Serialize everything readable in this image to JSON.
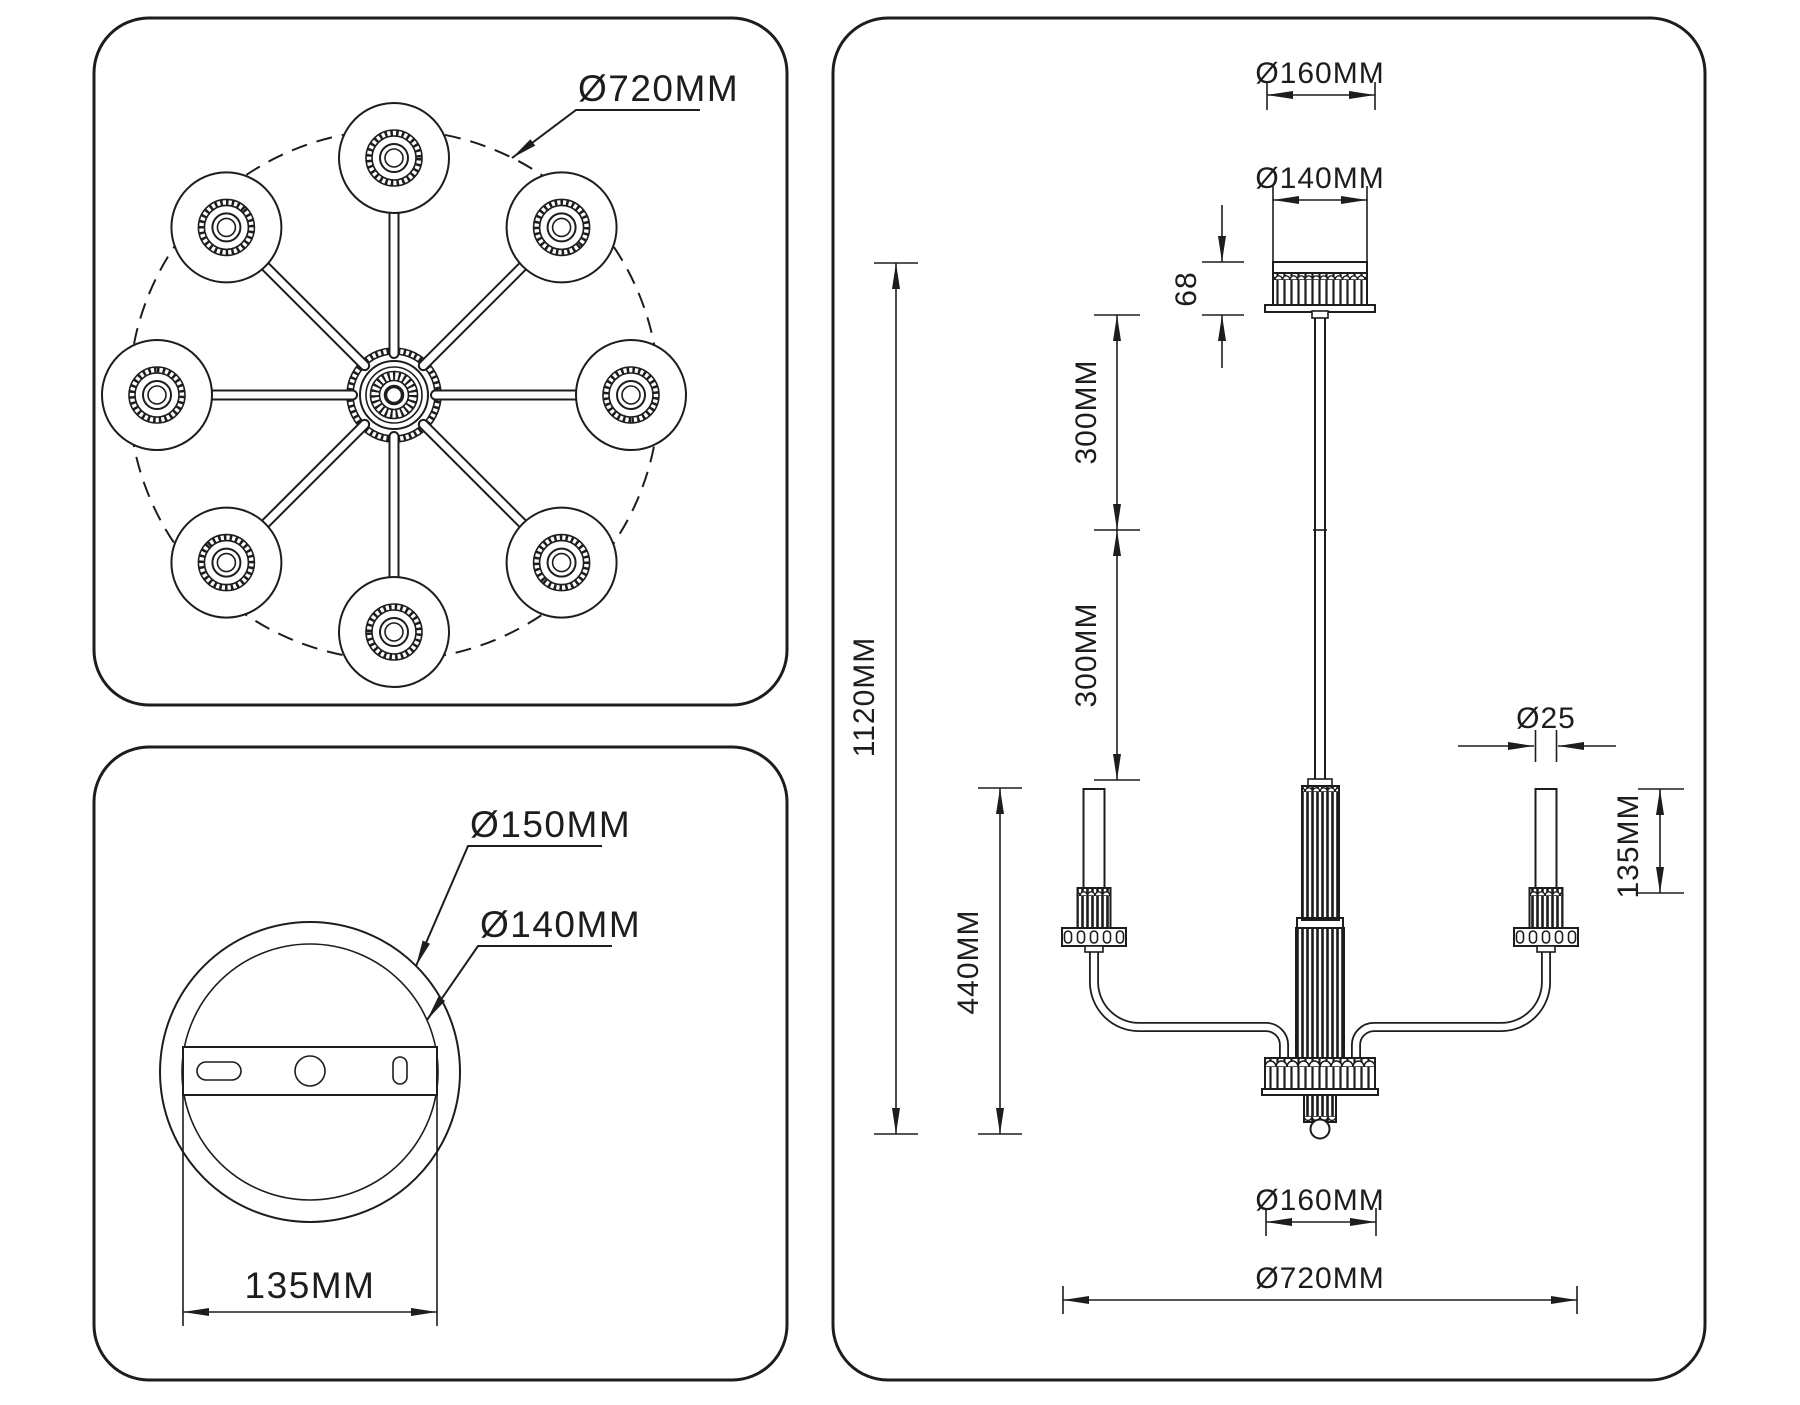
{
  "page": {
    "background": "#ffffff",
    "line_color": "#1d1d1d"
  },
  "top_view": {
    "diameter": "Ø720MM"
  },
  "mount_view": {
    "outer_diameter": "Ø150MM",
    "plate_diameter": "Ø140MM",
    "bracket_width": "135MM"
  },
  "side_view": {
    "canopy_flange_diameter": "Ø160MM",
    "canopy_diameter": "Ø140MM",
    "canopy_height": "68",
    "upper_rod_length": "300MM",
    "lower_rod_length": "300MM",
    "overall_height": "1120MM",
    "body_height": "440MM",
    "candle_diameter": "Ø25",
    "candle_height": "135MM",
    "hub_diameter": "Ø160MM",
    "overall_width": "Ø720MM"
  }
}
